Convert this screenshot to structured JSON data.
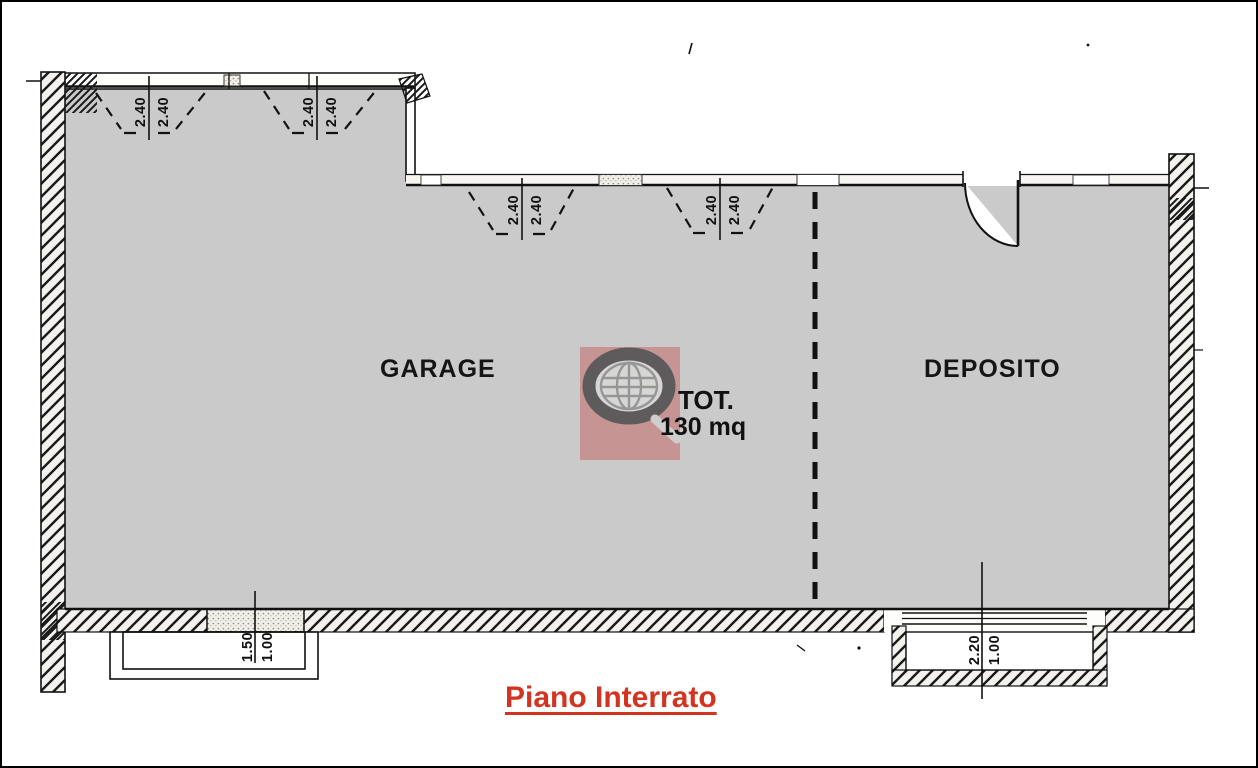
{
  "page": {
    "background": "#ffffff",
    "border_color": "#000000"
  },
  "plan": {
    "floor_title": "Piano Interrato",
    "rooms": [
      {
        "name": "GARAGE"
      },
      {
        "name": "DEPOSITO"
      }
    ],
    "total": {
      "label": "TOT.",
      "area": "130 mq"
    }
  },
  "dimensions": {
    "vent_labels": [
      "2.40",
      "2.40",
      "2.40",
      "2.40",
      "2.40",
      "2.40",
      "2.40",
      "2.40"
    ],
    "garage_window_well": {
      "width": "1.50",
      "depth": "1.00"
    },
    "deposito_window_well": {
      "width": "2.20",
      "depth": "1.00"
    }
  },
  "watermark": {
    "icon": "globe-logo",
    "square_color": "#c5827f",
    "ring_color": "#4e4c4c"
  },
  "colors": {
    "floor_fill": "#cacaca",
    "line": "#111111",
    "title_red": "#d23420"
  }
}
